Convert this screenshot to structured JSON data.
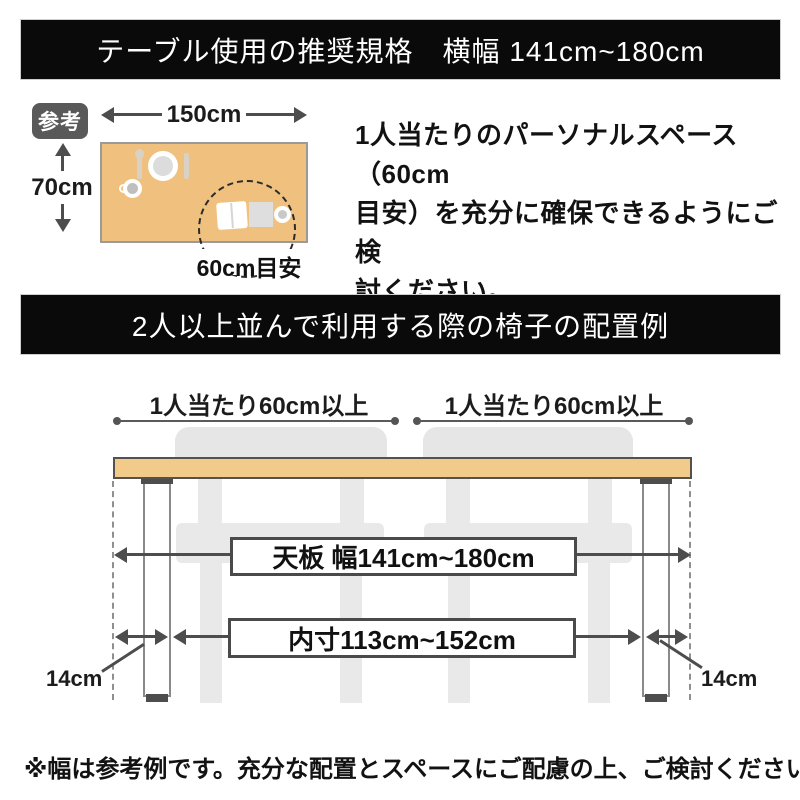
{
  "colors": {
    "banner-bg": "#0a0a0a",
    "table-ref": "#F0C17E",
    "table-top": "#F2CA8A",
    "chair": "#E9E9E9",
    "badge": "#595959",
    "line": "#4d4d4d",
    "text": "#121212"
  },
  "banner_top": {
    "label": "テーブル使用の推奨規格　横幅 141cm~180cm"
  },
  "reference": {
    "badge_label": "参考",
    "table_width_label": "150cm",
    "table_depth_label": "70cm",
    "personal_space_label": "60cm目安",
    "note_lines": [
      "1人当たりのパーソナルスペース（60cm",
      "目安）を充分に確保できるようにご検",
      "討ください。"
    ]
  },
  "banner_chairs": {
    "label": "2人以上並んで利用する際の椅子の配置例"
  },
  "layout_diagram": {
    "per_person_left_label": "1人当たり60cm以上",
    "per_person_right_label": "1人当たり60cm以上",
    "tabletop_width_label": "天板 幅141cm~180cm",
    "inner_width_label": "内寸113cm~152cm",
    "leg_inset_left_label": "14cm",
    "leg_inset_right_label": "14cm"
  },
  "footer": {
    "note": "※幅は参考例です。充分な配置とスペースにご配慮の上、ご検討ください。"
  }
}
